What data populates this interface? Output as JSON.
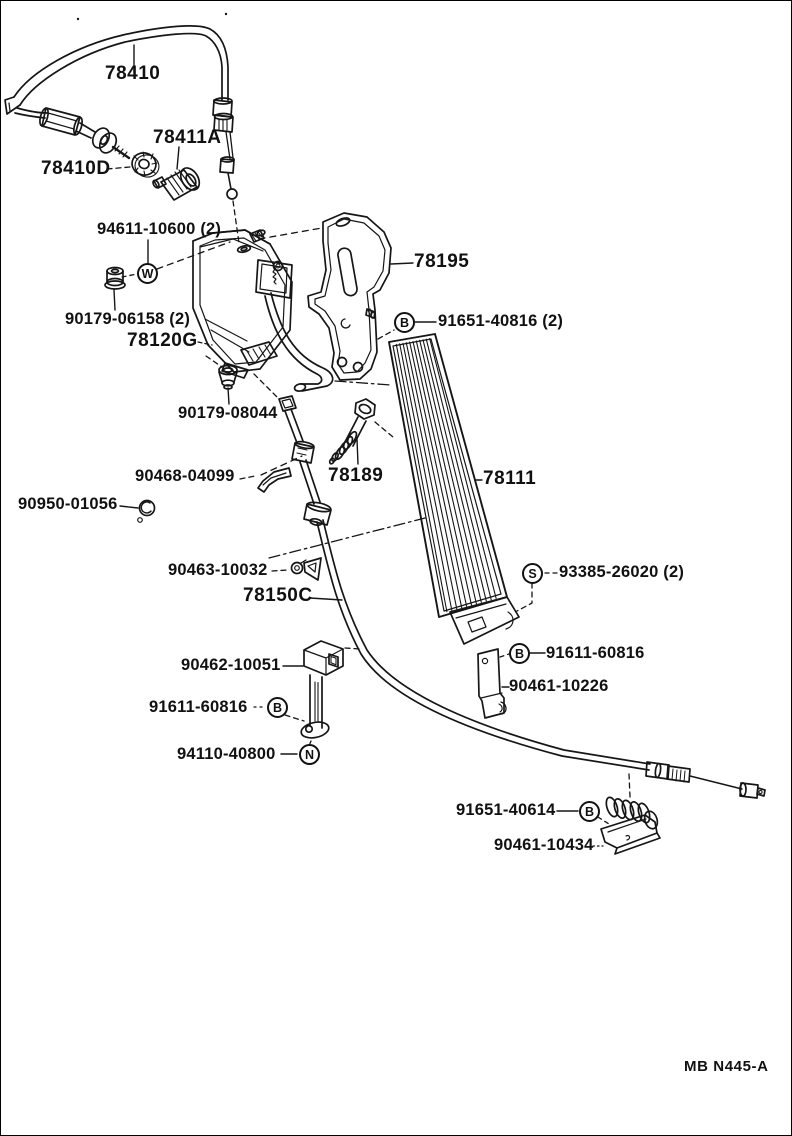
{
  "page": {
    "background": "#ffffff",
    "ink": "#161616"
  },
  "footer": {
    "drawing_code": "MB N445-A"
  },
  "parts": {
    "labels": [
      {
        "id": "78410",
        "text": "78410"
      },
      {
        "id": "78411A",
        "text": "78411A"
      },
      {
        "id": "78410D",
        "text": "78410D"
      },
      {
        "id": "94611-10600",
        "text": "94611-10600 (2)"
      },
      {
        "id": "78195",
        "text": "78195"
      },
      {
        "id": "90179-06158",
        "text": "90179-06158 (2)"
      },
      {
        "id": "78120G",
        "text": "78120G"
      },
      {
        "id": "91651-40816",
        "text": "91651-40816 (2)"
      },
      {
        "id": "90179-08044",
        "text": "90179-08044"
      },
      {
        "id": "90468-04099",
        "text": "90468-04099"
      },
      {
        "id": "78189",
        "text": "78189"
      },
      {
        "id": "78111",
        "text": "78111"
      },
      {
        "id": "90950-01056",
        "text": "90950-01056"
      },
      {
        "id": "90463-10032",
        "text": "90463-10032"
      },
      {
        "id": "93385-26020",
        "text": "93385-26020 (2)"
      },
      {
        "id": "78150C",
        "text": "78150C"
      },
      {
        "id": "90462-10051",
        "text": "90462-10051"
      },
      {
        "id": "91611-60816-right",
        "text": "91611-60816"
      },
      {
        "id": "90461-10226",
        "text": "90461-10226"
      },
      {
        "id": "91611-60816-left",
        "text": "91611-60816"
      },
      {
        "id": "94110-40800",
        "text": "94110-40800"
      },
      {
        "id": "91651-40614",
        "text": "91651-40614"
      },
      {
        "id": "90461-10434",
        "text": "90461-10434"
      }
    ]
  },
  "fastener_symbols": [
    {
      "id": "washer-w",
      "letter": "W"
    },
    {
      "id": "bolt-b-91651-40816",
      "letter": "B"
    },
    {
      "id": "screw-s-93385-26020",
      "letter": "S"
    },
    {
      "id": "bolt-b-91611-60816-right",
      "letter": "B"
    },
    {
      "id": "bolt-b-91611-60816-left",
      "letter": "B"
    },
    {
      "id": "nut-n-94110-40800",
      "letter": "N"
    },
    {
      "id": "bolt-b-91651-40614",
      "letter": "B"
    }
  ]
}
